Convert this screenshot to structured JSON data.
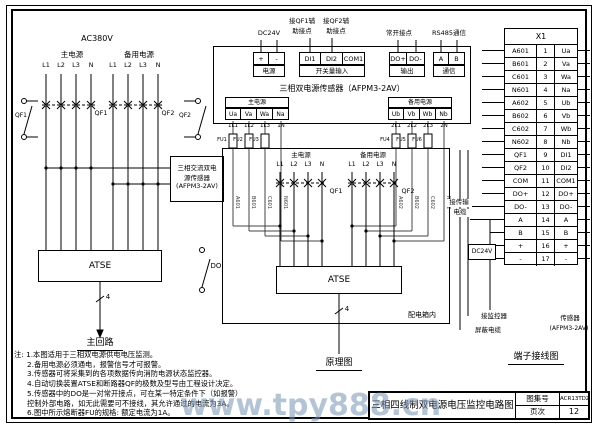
{
  "watermark": "www.tpy888.cn",
  "left": {
    "voltage": "AC380V",
    "main_label": "主电源",
    "backup_label": "备用电源",
    "phases": [
      "L1",
      "L2",
      "L3",
      "N"
    ],
    "breaker_main": "QF1",
    "breaker_backup": "QF2",
    "aux_main": "QF1",
    "aux_backup": "QF2",
    "sensor_box": {
      "line1": "三相交流双电",
      "line2": "源传感器",
      "line3": "(AFPM3-2AV)"
    },
    "atse": "ATSE",
    "branch_count": "4",
    "caption": "主回路",
    "do_label": "DO"
  },
  "notes": {
    "lines": [
      "注: 1.本图适用于三相双电源供电电压监测。",
      "2.备用电源必须通电，报警信号才可报警。",
      "3.传感器可将采集到的各项数据传向消防电源状态监控器。",
      "4.自动切换装置ATSE和断路器QF的极数及型号由工程设计决定。",
      "5.传感器中的DO是一对常开接点，可在某一特定条件下（如报警）",
      "控制外部电路，如无此需要可不接线，其允许通过的电流为3A。",
      "6.图中所示熔断器FU的规格: 额定电流为1A。"
    ]
  },
  "middle": {
    "annotations": {
      "dc24v": "DC24V",
      "qf1_aux_l1": "接QF1辅",
      "qf1_aux_l2": "助接点",
      "qf2_aux_l1": "接QF2辅",
      "qf2_aux_l2": "助接点",
      "no_contact": "常开接点",
      "rs485": "RS485通信"
    },
    "sensor": {
      "power_terms": [
        "+",
        "-"
      ],
      "power_label": "电源",
      "di_terms": [
        "DI1",
        "DI2",
        "COM1"
      ],
      "di_label": "开关量输入",
      "do_terms": [
        "DO+",
        "DO-"
      ],
      "do_label": "输出",
      "comm_terms": [
        "A",
        "B"
      ],
      "comm_label": "通信",
      "title": "三相双电源传感器（AFPM3-2AV）",
      "main_label": "主电源",
      "main_terms": [
        "Ua",
        "Va",
        "Wa",
        "Na"
      ],
      "backup_label": "备用电源",
      "backup_terms": [
        "Ub",
        "Vb",
        "Wb",
        "Nb"
      ]
    },
    "wires": {
      "main_tags": [
        "1L1",
        "1L2",
        "1L3",
        "1N"
      ],
      "backup_tags": [
        "2L1",
        "2L2",
        "2L3",
        "2N"
      ],
      "main_fuses": [
        "FU1",
        "FU2",
        "FU3"
      ],
      "backup_fuses": [
        "FU4",
        "FU5",
        "FU6"
      ],
      "main_ids": [
        "A601",
        "B601",
        "C601",
        "N601"
      ],
      "backup_ids": [
        "A602",
        "B602",
        "C602",
        "N602"
      ]
    },
    "inner": {
      "main_label": "主电源",
      "backup_label": "备用电源",
      "phases": [
        "L1",
        "L2",
        "L3",
        "N"
      ],
      "qf1": "QF1",
      "qf2": "QF2",
      "atse": "ATSE",
      "branch_count": "4",
      "box_label": "配电箱内",
      "caption": "原理图"
    }
  },
  "right": {
    "table_title": "X1",
    "rows": [
      [
        "A601",
        "1",
        "Ua"
      ],
      [
        "B601",
        "2",
        "Va"
      ],
      [
        "C601",
        "3",
        "Wa"
      ],
      [
        "N601",
        "4",
        "Na"
      ],
      [
        "A602",
        "5",
        "Ub"
      ],
      [
        "B602",
        "6",
        "Vb"
      ],
      [
        "C602",
        "7",
        "Wb"
      ],
      [
        "N602",
        "8",
        "Nb"
      ],
      [
        "QF1",
        "9",
        "DI1"
      ],
      [
        "QF2",
        "10",
        "DI2"
      ],
      [
        "COM",
        "11",
        "COM1"
      ],
      [
        "DO+",
        "12",
        "DO+"
      ],
      [
        "DO-",
        "13",
        "DO-"
      ],
      [
        "A",
        "14",
        "A"
      ],
      [
        "B",
        "15",
        "B"
      ],
      [
        "+",
        "16",
        "+"
      ],
      [
        "-",
        "17",
        "-"
      ]
    ],
    "dc24v": "DC24V",
    "cable_label": {
      "line1": "接传输",
      "line2": "电缆"
    },
    "monitor_label": "接监控器",
    "shield_label": "屏蔽电缆",
    "sensor_label": {
      "line1": "传感器",
      "line2": "(AFPM3-2AV)"
    },
    "caption": "端子接线图"
  },
  "title_block": {
    "title": "三相四线制双电源电压监控电路图",
    "atlas_label": "图集号",
    "atlas_no": "ACR13TDZ01",
    "page_label": "页次",
    "page_no": "12"
  }
}
